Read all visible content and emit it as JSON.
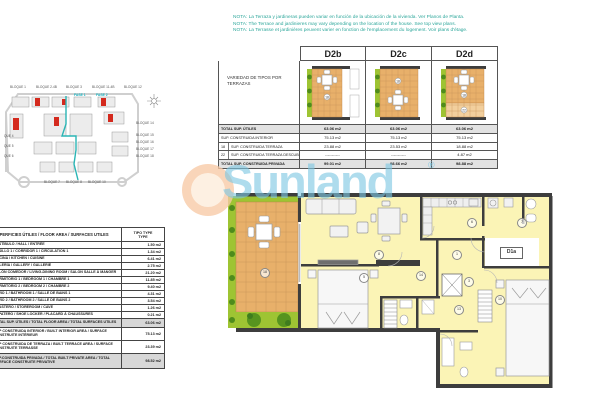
{
  "notes": {
    "es": "NOTA: La Terraza y jardineras pueden variar en función de la ubicación de la vivienda. Ver Planos de Planta.",
    "en": "NOTA: The Terrace and jardinieres may vary depending on the location of the house. See top view plans.",
    "fr": "NOTA: La Terrasse et jardinières peuvent varier en fonction de l'emplacement du logement. Voir plans d'étage."
  },
  "watermark": {
    "brand": "Sunland",
    "registered": "®"
  },
  "variants_table": {
    "corner_label": "VARIEDAD DE TIPOS POR TERRAZAS",
    "columns": [
      "D2b",
      "D2c",
      "D2d"
    ],
    "rows": [
      {
        "ref": "",
        "label": "TOTAL SUP. ÚTILES",
        "values": [
          "63.06 m2",
          "63.06 m2",
          "63.06 m2"
        ]
      },
      {
        "ref": "",
        "label": "SUP. CONSTRUIDA INTERIOR",
        "values": [
          "75.13 m2",
          "75.13 m2",
          "75.13 m2"
        ]
      },
      {
        "ref": "18",
        "label": "SUP. CONSTRUIDA TERRAZA",
        "values": [
          "23.88 m2",
          "23.53 m2",
          "18.88 m2"
        ]
      },
      {
        "ref": "22",
        "label": "SUP. CONSTRUIDA TERRAZA DESCUBIERTA",
        "values": [
          "-----------",
          "-----------",
          "4.87 m2"
        ]
      },
      {
        "ref": "",
        "label": "TOTAL SUP. CONSTRUIDA PRIVADA",
        "values": [
          "99.01 m2",
          "98.66 m2",
          "98.88 m2"
        ]
      }
    ]
  },
  "area_table": {
    "title": "SUPERFICIES ÚTILES / FLOOR AREA / SURFACES UTILES",
    "type_header_line1": "TIPO TYPE",
    "type_header_line2": "TYPE",
    "rows": [
      {
        "label": "VESTÍBULO / HALL / ENTRÉE",
        "value": "1.50 m2"
      },
      {
        "label": "PASILLO 1 / CORRIDOR 1 / CIRCULATION 1",
        "value": "1.34 m2"
      },
      {
        "label": "COCINA / KITCHEN / CUISINE",
        "value": "6.41 m2"
      },
      {
        "label": "GALERÍA / GALLERY / GALLERIE",
        "value": "2.75 m2"
      },
      {
        "label": "SALÓN COMEDOR / LIVING-DINING ROOM / SALON SALLE À MANGER",
        "value": "21.20 m2"
      },
      {
        "label": "DORMITORIO 1 / BEDROOM 1 / CHAMBRE 1",
        "value": "11.85 m2"
      },
      {
        "label": "DORMITORIO 2 / BEDROOM 2 / CHAMBRE 2",
        "value": "9.40 m2"
      },
      {
        "label": "BAÑO 1 / BATHROOM 1 / SALLE DE BAINS 1",
        "value": "4.31 m2"
      },
      {
        "label": "BAÑO 2 / BATHROOM 2 / SALLE DE BAINS 2",
        "value": "3.54 m2"
      },
      {
        "label": "TRASTERO / STOREROOM / CAVE",
        "value": "1.26 m2"
      },
      {
        "label": "ZAPATERO / SHOE LOCKER / PLACARD À CHAUSSURES",
        "value": "0.21 m2"
      }
    ],
    "totals": [
      {
        "label": "TOTAL SUP. ÚTILES / TOTAL FLOOR AREA / TOTAL SURFACES UTILES",
        "value": "63.06 m2",
        "shaded": true,
        "h": "h9"
      },
      {
        "label": "SUP CONSTRUIDA INTERIOR / BUILT INTERIOR AREA / SURFACE CONSTRUITE INTÉRIEUR",
        "value": "75.13 m2",
        "shaded": false,
        "h": "h13"
      },
      {
        "label": "SUP CONSTRUIDA DE TERRAZA / BUILT TERRACE AREA / SURFACE CONSTRUITE TERRASSE",
        "value": "23.39 m2",
        "shaded": false,
        "h": "h13"
      },
      {
        "label": "SUP.CONSTRUIDA PRIVADA / TOTAL BUILT PRIVATE AREA / TOTAL SURFACE CONSTRUITE PRIVATIVE",
        "value": "98.52 m2",
        "shaded": true,
        "h": "h15"
      }
    ]
  },
  "site_plan": {
    "fase_labels": [
      {
        "text": "FASE 1",
        "x": 70,
        "y": 9
      },
      {
        "text": "FASE 2",
        "x": 92,
        "y": 9
      }
    ],
    "labels": [
      {
        "text": "BLOQUE 1",
        "x": 6,
        "y": 1
      },
      {
        "text": "BLOQUE 2-4B",
        "x": 32,
        "y": 1
      },
      {
        "text": "BLOQUE 3",
        "x": 62,
        "y": 1
      },
      {
        "text": "BLOQUE 11-4B",
        "x": 88,
        "y": 1
      },
      {
        "text": "BLOQUE 12",
        "x": 120,
        "y": 1
      },
      {
        "text": "BLOQUE 14",
        "x": 132,
        "y": 37
      },
      {
        "text": "BLOQUE 15",
        "x": 132,
        "y": 49
      },
      {
        "text": "BLOQUE 16",
        "x": 132,
        "y": 56
      },
      {
        "text": "BLOQUE 17",
        "x": 132,
        "y": 63
      },
      {
        "text": "BLOQUE 18",
        "x": 132,
        "y": 70
      },
      {
        "text": "BLOQUE 7",
        "x": 40,
        "y": 96
      },
      {
        "text": "BLOQUE 8",
        "x": 62,
        "y": 96
      },
      {
        "text": "BLOQUE 10",
        "x": 84,
        "y": 96
      },
      {
        "text": "QUE 4",
        "x": 0,
        "y": 50
      },
      {
        "text": "QUE 5",
        "x": 0,
        "y": 60
      },
      {
        "text": "QUE 6",
        "x": 0,
        "y": 70
      }
    ]
  },
  "floor_plan": {
    "unit_label": "D1a",
    "room_numbers": [
      {
        "n": "18",
        "x": 34,
        "y": 76
      },
      {
        "n": "8",
        "x": 148,
        "y": 58
      },
      {
        "n": "5",
        "x": 133,
        "y": 81
      },
      {
        "n": "6",
        "x": 241,
        "y": 26
      },
      {
        "n": "7",
        "x": 291,
        "y": 26
      },
      {
        "n": "1",
        "x": 226,
        "y": 58
      },
      {
        "n": "3",
        "x": 238,
        "y": 85
      },
      {
        "n": "14",
        "x": 190,
        "y": 79
      },
      {
        "n": "13",
        "x": 228,
        "y": 113
      },
      {
        "n": "10",
        "x": 269,
        "y": 103
      }
    ]
  }
}
